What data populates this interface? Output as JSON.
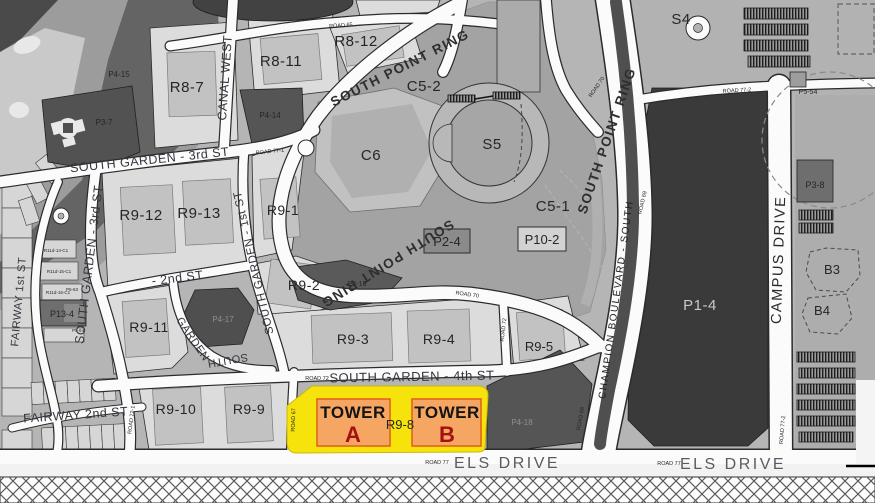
{
  "map": {
    "title": "campus district parcel plan",
    "labels": {
      "r8_7": "R8-7",
      "r8_11": "R8-11",
      "r8_12": "R8-12",
      "s4": "S4",
      "c5_2": "C5-2",
      "s5": "S5",
      "c6": "C6",
      "c5_1": "C5-1",
      "p2_4": "P2-4",
      "p10_2": "P10-2",
      "r9_1": "R9-1",
      "r9_12": "R9-12",
      "r9_13": "R9-13",
      "r9_2": "R9-2",
      "r9_11": "R9-11",
      "r9_3": "R9-3",
      "r9_4": "R9-4",
      "r9_5": "R9-5",
      "r9_10": "R9-10",
      "r9_9": "R9-9",
      "r9_8": "R9-8",
      "p1_4": "P1-4",
      "p3_7": "P3-7",
      "p4_15": "P4-15",
      "p4_14": "P4-14",
      "p13_4": "P13-4",
      "p4_17": "P4-17",
      "p4_16": "P4-16",
      "p4_18": "P4-18",
      "p3_8": "P3-8",
      "b3": "B3",
      "b4": "B4",
      "p5_54": "P5-54",
      "p5_63": "P5-63",
      "p5_64": "P5-64",
      "r11d_14": "R11d-14-C1",
      "r11d_15": "R11d-15-C1",
      "r11d_16": "R11d-16-C1"
    },
    "streets": {
      "canal_west": "CANAL WEST",
      "south_point_ring_top": "SOUTH POINT RING",
      "south_point_ring_lower": "SOUTH POINT RING",
      "south_point_ring_east": "SOUTH POINT RING",
      "garden_3rd_h": "SOUTH GARDEN - 3rd ST",
      "garden_3rd_v": "SOUTH GARDEN - 3rd ST",
      "garden_1st": "SOUTH GARDEN - 1st ST",
      "second_st": "- 2nd ST",
      "garden_4th": "SOUTH GARDEN - 4th ST",
      "fairway_1st": "FAIRWAY 1st ST",
      "fairway_2nd": "FAIRWAY 2nd ST",
      "els_drive_w": "ELS DRIVE",
      "els_drive_e": "ELS DRIVE",
      "campus_drive": "CAMPUS DRIVE",
      "champion_blvd": "CHAMPION BOULEVARD - SOUTH",
      "south_frag": "SOUTH",
      "garden_frag": "GARDEN"
    },
    "roads": {
      "r65": "ROAD 65",
      "r70_low": "ROAD 70",
      "r70_up": "ROAD 70",
      "r69": "ROAD 69",
      "r68": "ROAD 68",
      "r67": "ROAD 67",
      "r72_4th": "ROAD 72",
      "r72_v": "ROAD 72",
      "r72_1": "ROAD 72-1",
      "r77_w": "ROAD 77",
      "r77_e": "ROAD 77",
      "r77_1": "ROAD 77-1",
      "r77_2_top": "ROAD 77-2",
      "r77_2_right": "ROAD 77-2"
    },
    "towers": {
      "word_a": "TOWER",
      "letter_a": "A",
      "word_b": "TOWER",
      "letter_b": "B"
    },
    "colors": {
      "highlight_parcel": "#f6e30b",
      "tower_box_fill": "#f5a662",
      "tower_box_border": "#e2641a",
      "tower_letter": "#a31111",
      "dark_parcel": "#3a3a3a"
    }
  }
}
